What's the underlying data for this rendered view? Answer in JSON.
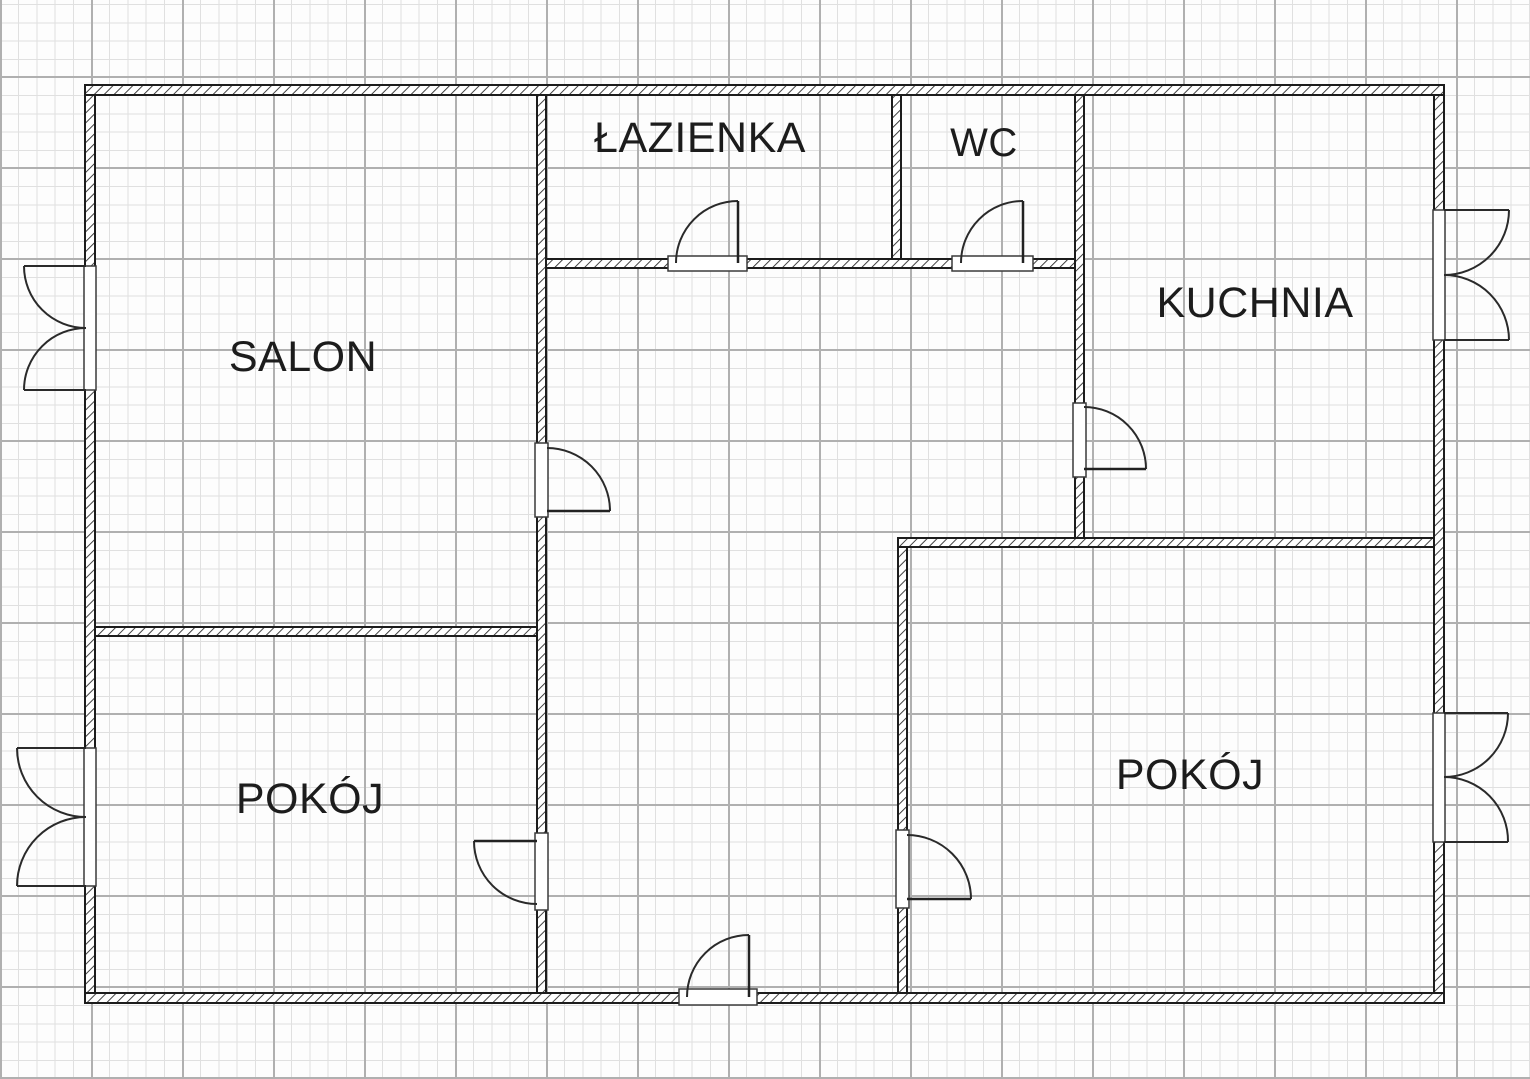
{
  "plan": {
    "type": "floor-plan",
    "rooms": [
      {
        "id": "salon",
        "label": "SALON"
      },
      {
        "id": "lazienka",
        "label": "ŁAZIENKA"
      },
      {
        "id": "wc",
        "label": "WC"
      },
      {
        "id": "kuchnia",
        "label": "KUCHNIA"
      },
      {
        "id": "pokoj_left",
        "label": "POKÓJ"
      },
      {
        "id": "pokoj_right",
        "label": "POKÓJ"
      }
    ],
    "colors": {
      "paper": "#fdfdfd",
      "grid_minor": "#e0e0e0",
      "grid_major": "#b0b0b0",
      "wall_line": "#1c1c1c",
      "label_text": "#1c1c1c"
    }
  }
}
